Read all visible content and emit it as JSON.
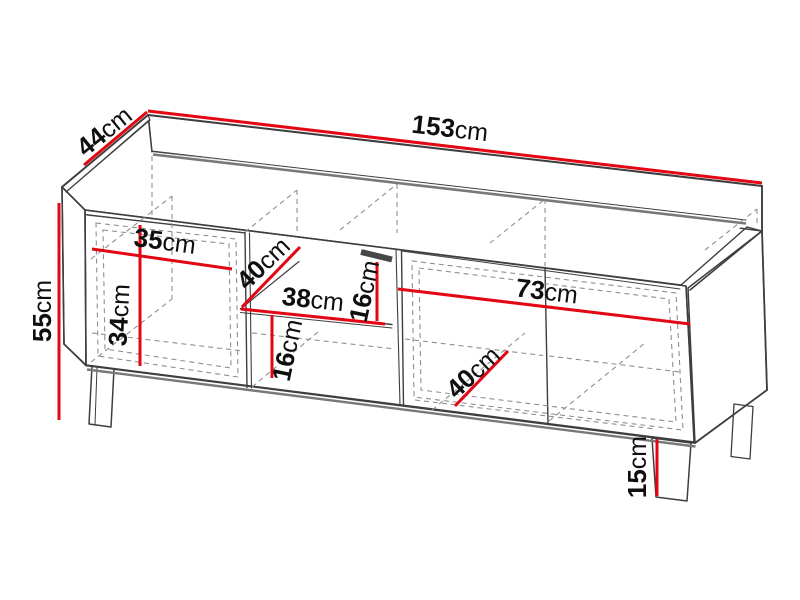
{
  "diagram": {
    "type": "furniture-dimension-drawing",
    "background": "#ffffff",
    "colors": {
      "dimension_line": "#e30613",
      "outline": "#3e3e3e",
      "hidden_line": "#8f8f8f"
    },
    "unit": "cm"
  },
  "dims": {
    "total_width": {
      "value": "153",
      "unit": "cm"
    },
    "total_depth": {
      "value": "44",
      "unit": "cm"
    },
    "total_height": {
      "value": "55",
      "unit": "cm"
    },
    "left_door_width": {
      "value": "35",
      "unit": "cm"
    },
    "interior_height": {
      "value": "34",
      "unit": "cm"
    },
    "shelf_depth": {
      "value": "40",
      "unit": "cm"
    },
    "niche_width": {
      "value": "38",
      "unit": "cm"
    },
    "niche_upper_height": {
      "value": "16",
      "unit": "cm"
    },
    "niche_lower_height": {
      "value": "16",
      "unit": "cm"
    },
    "right_door_width": {
      "value": "73",
      "unit": "cm"
    },
    "right_interior_depth": {
      "value": "40",
      "unit": "cm"
    },
    "leg_height": {
      "value": "15",
      "unit": "cm"
    }
  }
}
